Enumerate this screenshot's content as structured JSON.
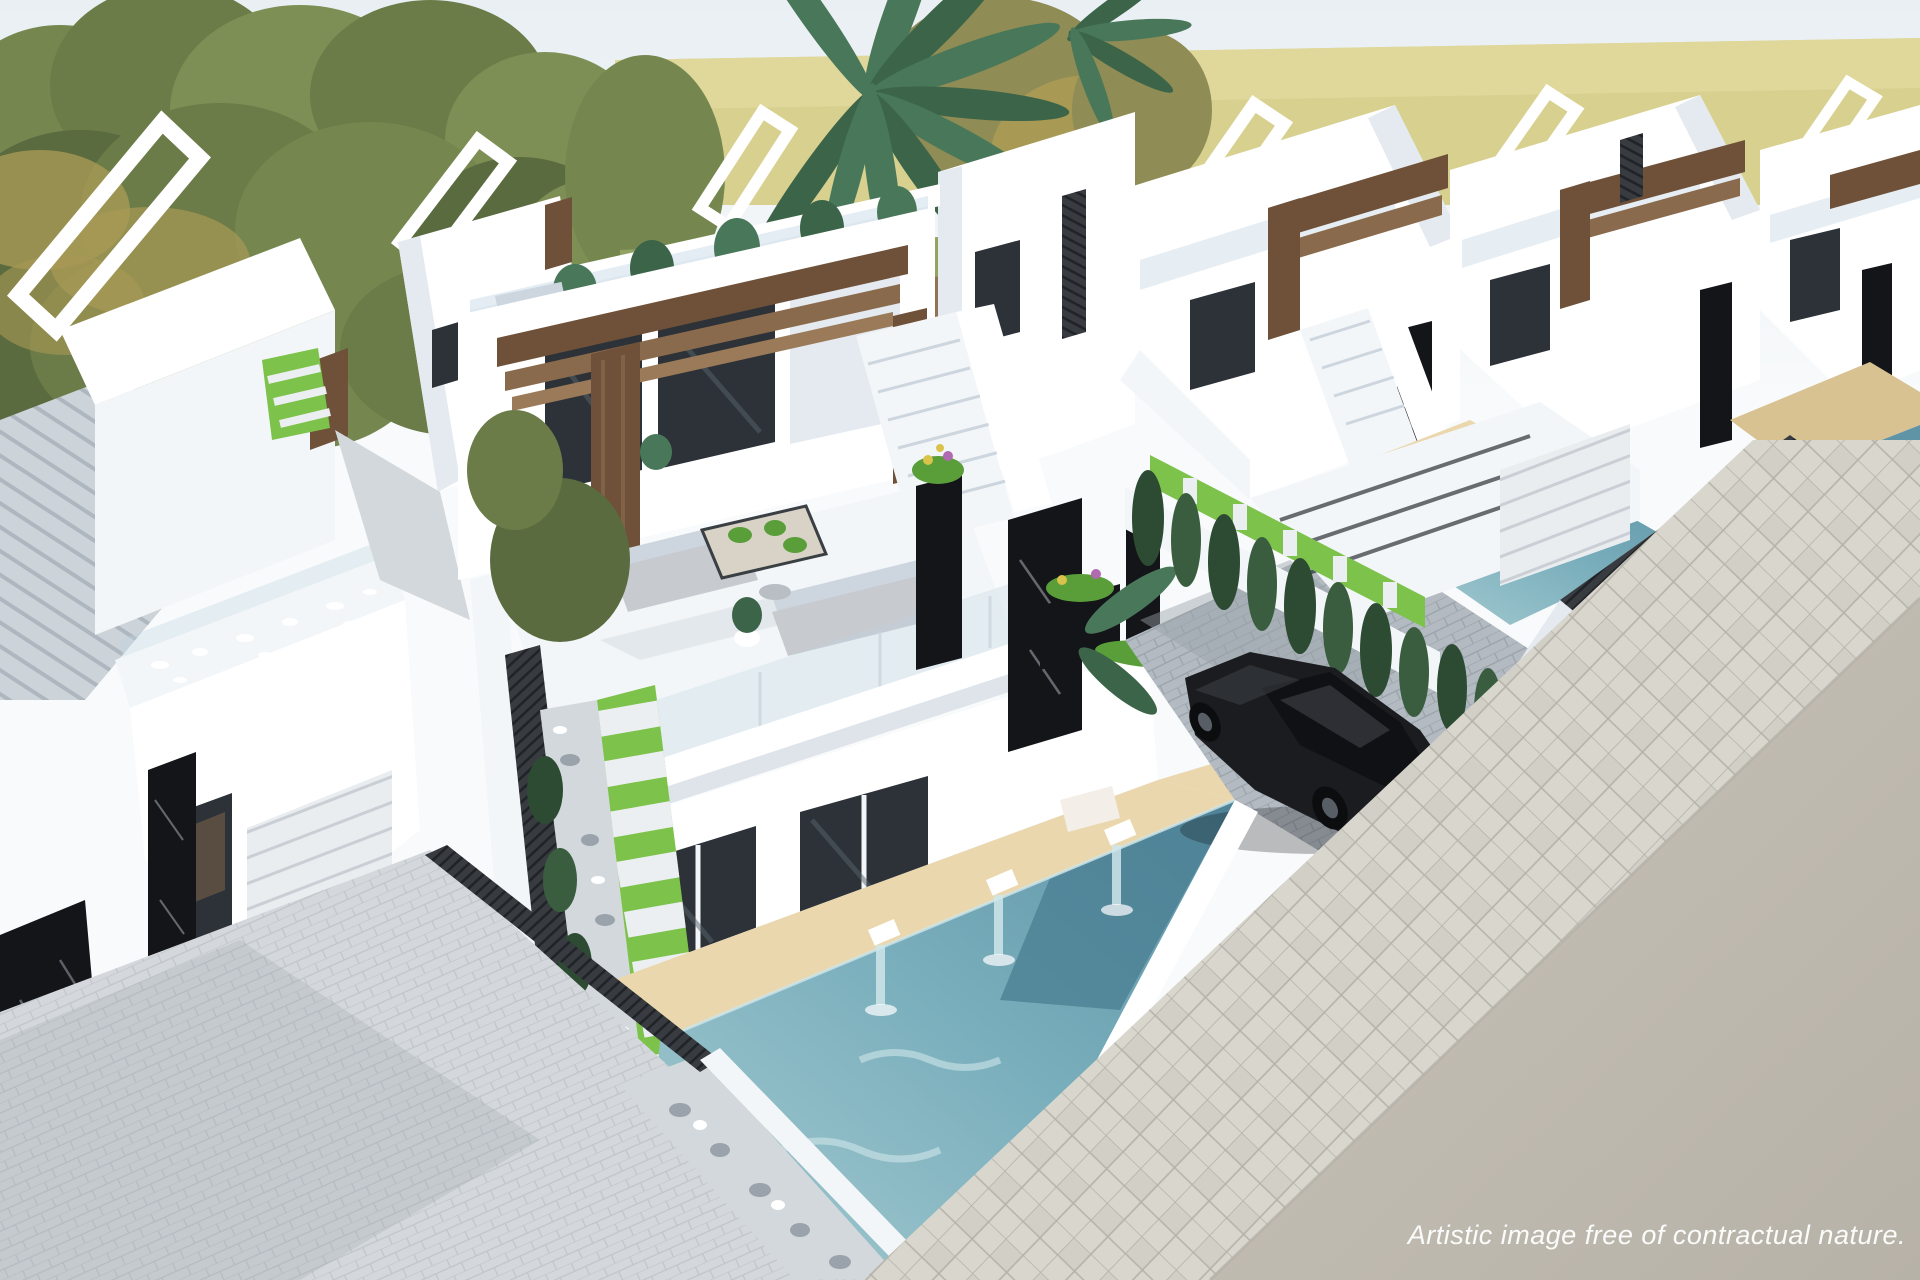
{
  "caption": {
    "text": "Artistic image free of contractual nature."
  },
  "palette": {
    "sky": "#e9eff3",
    "skyWhite": "#f8fafb",
    "field": "#d7d08f",
    "fieldLight": "#e3dc9e",
    "horizon": "#c5bd82",
    "treeGreen": "#75874f",
    "treeMid": "#6b7c48",
    "treeDark": "#5a6b3f",
    "treeLight": "#7d8f55",
    "treeOlive": "#8f8c55",
    "treeGold": "#a89a55",
    "soil": "#8f7354",
    "meadow": "#93a362",
    "trunk": "#5d4a36",
    "palm": "#49775a",
    "palmDark": "#3c6449",
    "white": "#ffffff",
    "wallLight": "#f3f6f8",
    "wallShade": "#e4eaef",
    "wallDark": "#cdd6de",
    "wood": "#6e5138",
    "woodLight": "#8a6a4c",
    "woodPale": "#9a7a58",
    "marble": "#141519",
    "marbleVein": "#9aa0a7",
    "windowDark": "#2c3238",
    "windowMid": "#5a646c",
    "glass": "#bcd3e2",
    "poolLight": "#a7ccd1",
    "poolTeal": "#79aebc",
    "poolDeep": "#5f93a6",
    "poolDark": "#497e92",
    "ripple": "#cfe6ea",
    "deck": "#ead7ad",
    "deckShade": "#d9c292",
    "grass": "#7dc24b",
    "grassDark": "#5a9e3a",
    "slab": "#eceff1",
    "paveLight": "#d4d8dc",
    "paveMid": "#b3bac2",
    "paveDark": "#99a1a9",
    "paveLine": "#bfc5ca",
    "gravel": "#d3d8dc",
    "rock": "#9aa3ab",
    "fence": "#383c41",
    "fenceSlat": "#202327",
    "road": "#b7b2a8",
    "roadLight": "#c8c3b9",
    "walkTile": "#d9d6cd",
    "walkTileAlt": "#ccc9c0",
    "walkLine": "#b5b2a9",
    "car": "#1b1c1f",
    "carDark": "#101114",
    "carLight": "#45494e",
    "cypress": "#2d4b33",
    "cypressLight": "#3a5d40",
    "caption": "#ffffff"
  }
}
